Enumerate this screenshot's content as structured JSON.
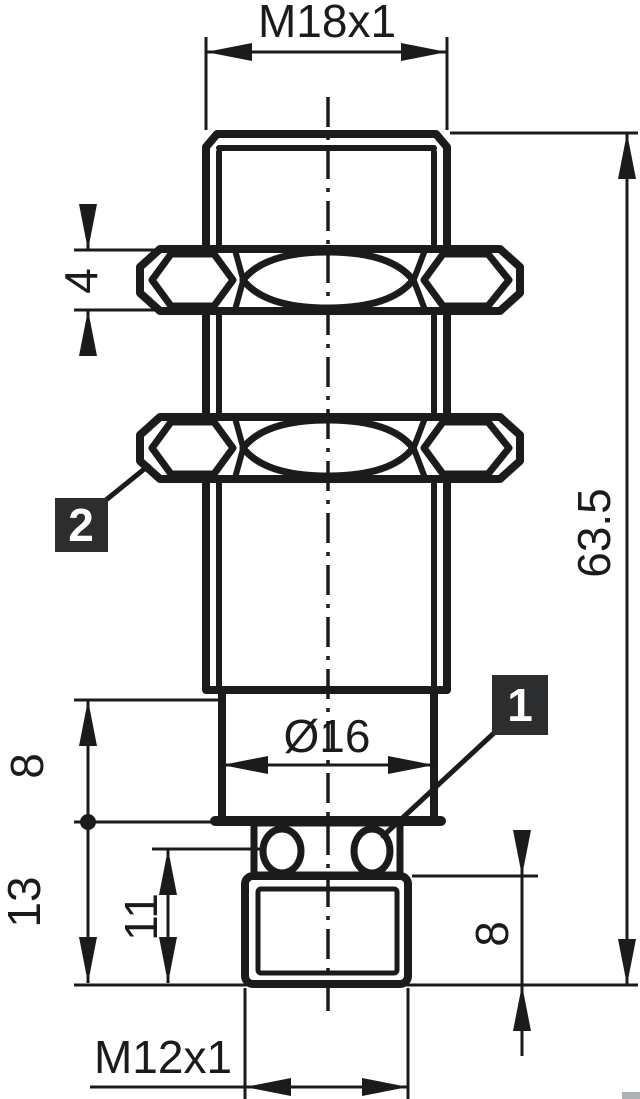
{
  "drawing": {
    "dimensions": {
      "top_thread": "M18x1",
      "overall_length": "63.5",
      "nut_thickness": "4",
      "shoulder_height": "8",
      "lower_length": "13",
      "groove_length": "11",
      "body_diameter": "Ø16",
      "connector_thread_length": "8",
      "connector_thread": "M12x1"
    },
    "callouts": {
      "item1": "1",
      "item2": "2"
    },
    "colors": {
      "line": "#1b1b1b",
      "callout_bg": "#2b2d2f",
      "callout_text": "#ffffff",
      "background": "#ffffff",
      "corner_artifact": "#aeb1b3"
    }
  }
}
